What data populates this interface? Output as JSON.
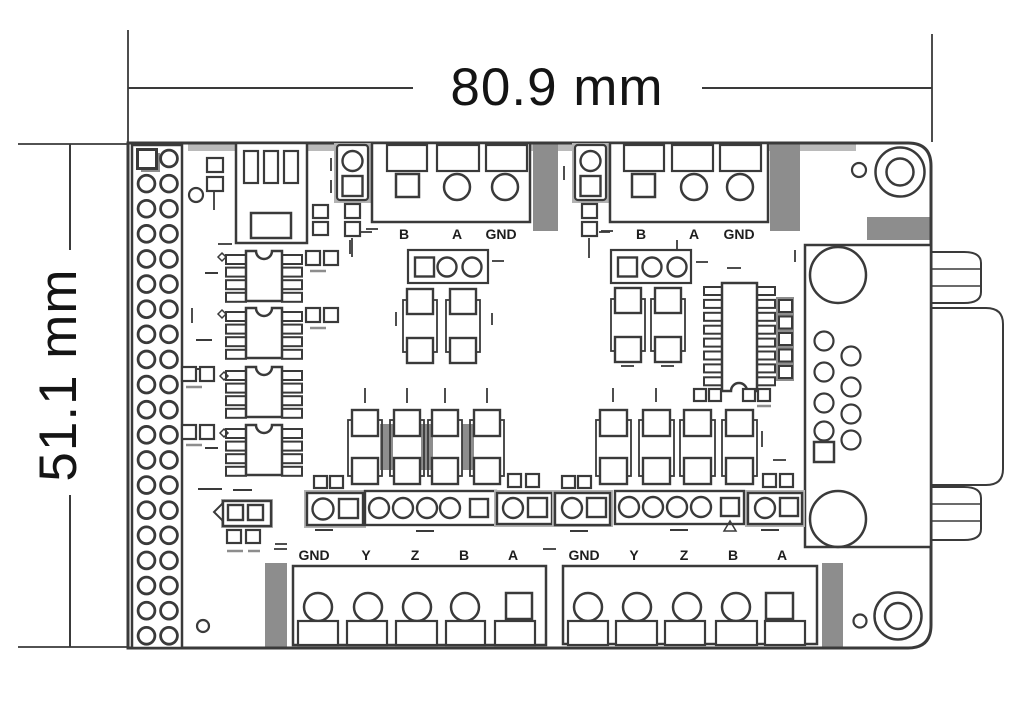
{
  "dimensions": {
    "width_label": "80.9 mm",
    "height_label": "51.1 mm"
  },
  "terminal_blocks": {
    "top_left": {
      "labels": [
        "B",
        "A",
        "GND"
      ]
    },
    "top_right": {
      "labels": [
        "B",
        "A",
        "GND"
      ]
    },
    "bottom_left": {
      "labels": [
        "GND",
        "Y",
        "Z",
        "B",
        "A"
      ]
    },
    "bottom_right": {
      "labels": [
        "GND",
        "Y",
        "Z",
        "B",
        "A"
      ]
    }
  },
  "components": [
    "pin-header-2x20",
    "usb-b-connector",
    "screw-terminal-b-a-gnd-left",
    "screw-terminal-b-a-gnd-right",
    "db9-connector",
    "mounting-hole-top-right",
    "mounting-hole-bottom-right",
    "soic8-ic-1",
    "soic8-ic-2",
    "soic8-ic-3",
    "soic8-ic-4",
    "soic16-ic",
    "pin-header-3pin-left",
    "pin-header-3pin-right",
    "jumper-2pin-arrow",
    "screw-terminal-gnd-y-z-b-a-left",
    "screw-terminal-gnd-y-z-b-a-right"
  ],
  "colors": {
    "line": "#3a3a3a",
    "fill_gray": "#8d8d8d",
    "light_gray": "#b2b2b2",
    "background": "#ffffff"
  }
}
